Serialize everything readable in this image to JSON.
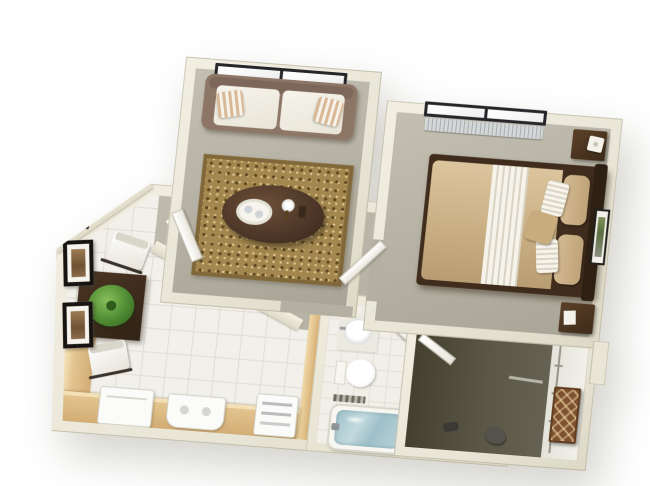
{
  "scene": {
    "description": "3D isometric rendering of a one-bedroom apartment floor plan viewed from above, on a plain white background, no text labels",
    "background_color": "#ffffff",
    "wall_color": "#e9e6d8"
  },
  "palette": {
    "wall_cream": "#e9e6d8",
    "wall_highlight": "#f2efe2",
    "wall_shadow": "#ddd9c6",
    "carpet_gray": "#b3afa2",
    "tile_white": "#f2f0ea",
    "tile_line": "#dfdcd2",
    "rug_gold": "#a3874e",
    "rug_border": "#81683a",
    "sofa_frame_taupe": "#8d7666",
    "sofa_cushion_white": "#f1eee5",
    "pillow_stripe_tan": "#d9b896",
    "dark_wood": "#3f2c1c",
    "comforter_tan": "#ccb28b",
    "sheet_white": "#f6f3ea",
    "counter_maple": "#e3c48f",
    "appliance_white": "#fbfbf9",
    "plant_green": "#4e8a33",
    "bath_water_blue": "#a6c4cb",
    "closet_floor_olive": "#55523f",
    "wicker_brown": "#7e5230",
    "window_frame_black": "#26262a",
    "radiator_gray": "#c0c4c5",
    "art_frame_black": "#171310"
  },
  "rooms": {
    "living_room": {
      "name": "living room",
      "floor": "gray carpet",
      "items": [
        "double window on top wall",
        "white sofa with taupe frame",
        "two striped throw pillows",
        "gold patterned area rug",
        "dark oval coffee table",
        "white serving tray with cups",
        "white flowers",
        "small dark vase",
        "open white door"
      ]
    },
    "bedroom": {
      "name": "bedroom",
      "floor": "gray carpet",
      "items": [
        "double window on top wall",
        "radiator under window",
        "double bed with dark wood frame",
        "tan comforter",
        "white striped folded sheet",
        "two tan pillows",
        "two white striped pillows",
        "tan accent pillow",
        "two dark nightstands",
        "white table lamp",
        "framed botanical wall art",
        "open white door to hallway"
      ]
    },
    "dining_kitchen": {
      "name": "dining area and kitchen",
      "floor": "white tile",
      "items": [
        "two black framed pictures on left wall",
        "small window on angled wall",
        "dark square dining table",
        "green potted plant centerpiece",
        "two white chairs",
        "L-shaped maple counter",
        "white refrigerator appliance",
        "white stove unit",
        "white wall oven in wood partition",
        "wood partition wall",
        "open white door to living room"
      ]
    },
    "bathroom": {
      "name": "bathroom",
      "floor": "white tile",
      "items": [
        "round white sink on vanity",
        "faucet",
        "toilet",
        "bathtub filled with blue water",
        "tub faucet",
        "striped towel",
        "open white door"
      ]
    },
    "walk_in_closet": {
      "name": "walk-in closet",
      "floor": "dark olive carpet",
      "items": [
        "white shelving with hanging rod along right wall",
        "wicker basket tower",
        "dark duffel bag",
        "dark shoe",
        "open white door"
      ]
    },
    "hallway": {
      "name": "hallway",
      "floor": "gray carpet",
      "items": []
    }
  }
}
